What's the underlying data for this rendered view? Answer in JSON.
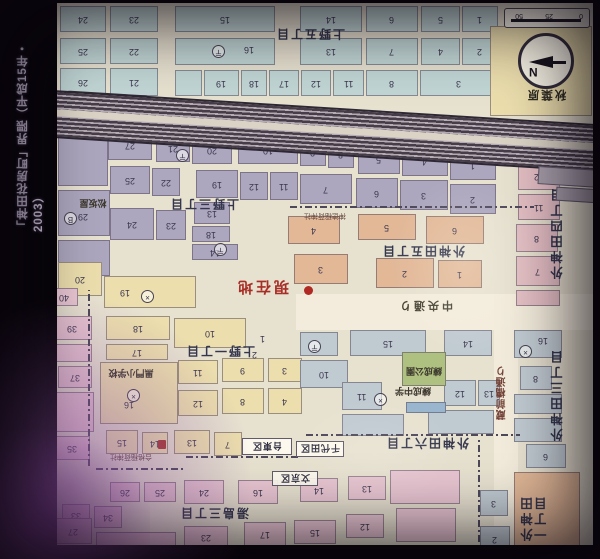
{
  "page": {
    "title": "「神田花房町」界隈（平成15年・2003）",
    "photo_note": "map printed upside-down in photo"
  },
  "compass": {
    "north": "N"
  },
  "scale_bar": {
    "t0": "0",
    "t1": "25",
    "t2": "50"
  },
  "palette": {
    "bl": "#b9d5d8",
    "pu": "#aaa3c5",
    "or": "#e8b48d",
    "sa": "#e7b9c3",
    "yl": "#ecdca1",
    "pk": "#ecc0d3",
    "bg": "#bac9d5",
    "gr": "#a9c272",
    "po": "#8fb5d7",
    "paper": "#e7e1d0",
    "accent_red": "#c0261c",
    "rail": "#463b4b"
  },
  "map": {
    "blocks": [
      [
        60,
        6,
        46,
        26,
        "bl",
        "24"
      ],
      [
        110,
        6,
        48,
        26,
        "bl",
        "23"
      ],
      [
        175,
        6,
        100,
        26,
        "bl",
        "15"
      ],
      [
        300,
        6,
        62,
        26,
        "bl",
        "14"
      ],
      [
        366,
        6,
        52,
        26,
        "bl",
        "6"
      ],
      [
        421,
        6,
        39,
        26,
        "bl",
        "5"
      ],
      [
        462,
        6,
        36,
        26,
        "bl",
        "1"
      ],
      [
        60,
        38,
        46,
        26,
        "bl",
        "25"
      ],
      [
        110,
        38,
        48,
        26,
        "bl",
        "22"
      ],
      [
        175,
        38,
        100,
        27,
        "bl",
        ""
      ],
      [
        300,
        38,
        62,
        27,
        "bl",
        "13"
      ],
      [
        366,
        38,
        52,
        27,
        "bl",
        "7"
      ],
      [
        421,
        38,
        39,
        27,
        "bl",
        "4"
      ],
      [
        462,
        38,
        36,
        27,
        "bl",
        "2"
      ],
      [
        60,
        68,
        46,
        28,
        "bl",
        "26"
      ],
      [
        110,
        68,
        48,
        28,
        "bl",
        "21"
      ],
      [
        175,
        70,
        27,
        26,
        "bl",
        ""
      ],
      [
        204,
        70,
        35,
        26,
        "bl",
        "19"
      ],
      [
        241,
        70,
        26,
        26,
        "bl",
        "18"
      ],
      [
        269,
        70,
        30,
        26,
        "bl",
        "17"
      ],
      [
        301,
        70,
        30,
        26,
        "bl",
        "12"
      ],
      [
        333,
        70,
        31,
        26,
        "bl",
        "11"
      ],
      [
        366,
        70,
        52,
        26,
        "bl",
        "8"
      ],
      [
        420,
        70,
        78,
        26,
        "bl",
        "3"
      ],
      [
        490,
        26,
        102,
        90,
        "yl",
        ""
      ],
      [
        58,
        124,
        50,
        62,
        "pu",
        ""
      ],
      [
        58,
        190,
        52,
        46,
        "pu",
        ""
      ],
      [
        58,
        240,
        52,
        36,
        "pu",
        ""
      ],
      [
        108,
        130,
        44,
        30,
        "pu",
        "27"
      ],
      [
        156,
        134,
        34,
        28,
        "pu",
        "21"
      ],
      [
        192,
        136,
        40,
        28,
        "pu",
        "20"
      ],
      [
        238,
        136,
        60,
        28,
        "pu",
        "10"
      ],
      [
        300,
        138,
        26,
        28,
        "pu",
        "9"
      ],
      [
        328,
        140,
        26,
        28,
        "pu",
        "8"
      ],
      [
        358,
        144,
        42,
        30,
        "pu",
        "5"
      ],
      [
        402,
        146,
        46,
        30,
        "pu",
        "4"
      ],
      [
        450,
        150,
        46,
        30,
        "pu",
        "1"
      ],
      [
        110,
        166,
        40,
        28,
        "pu",
        "25"
      ],
      [
        152,
        168,
        28,
        28,
        "pu",
        "22"
      ],
      [
        196,
        170,
        42,
        28,
        "pu",
        "19"
      ],
      [
        240,
        172,
        28,
        28,
        "pu",
        "12"
      ],
      [
        270,
        172,
        28,
        28,
        "pu",
        "11"
      ],
      [
        300,
        174,
        52,
        30,
        "pu",
        "7"
      ],
      [
        356,
        178,
        42,
        30,
        "pu",
        "6"
      ],
      [
        400,
        180,
        48,
        30,
        "pu",
        "3"
      ],
      [
        450,
        184,
        46,
        30,
        "pu",
        "2"
      ],
      [
        110,
        208,
        44,
        32,
        "pu",
        "24"
      ],
      [
        156,
        210,
        30,
        30,
        "pu",
        "23"
      ],
      [
        194,
        202,
        36,
        22,
        "pu",
        "13"
      ],
      [
        192,
        226,
        38,
        16,
        "pu",
        "18"
      ],
      [
        192,
        244,
        46,
        16,
        "pu",
        "14"
      ],
      [
        288,
        216,
        52,
        28,
        "or",
        "4"
      ],
      [
        358,
        214,
        58,
        26,
        "or",
        "5"
      ],
      [
        426,
        216,
        58,
        28,
        "or",
        "6"
      ],
      [
        294,
        254,
        54,
        30,
        "or",
        "3"
      ],
      [
        376,
        258,
        58,
        30,
        "or",
        "2"
      ],
      [
        438,
        260,
        44,
        28,
        "or",
        "1"
      ],
      [
        518,
        162,
        42,
        28,
        "sa",
        "12"
      ],
      [
        518,
        194,
        42,
        26,
        "sa",
        "11"
      ],
      [
        516,
        224,
        42,
        28,
        "sa",
        "8"
      ],
      [
        516,
        256,
        44,
        30,
        "sa",
        "7"
      ],
      [
        516,
        290,
        44,
        16,
        "sa",
        ""
      ],
      [
        58,
        262,
        44,
        34,
        "yl",
        "20"
      ],
      [
        104,
        276,
        92,
        32,
        "yl",
        ""
      ],
      [
        106,
        316,
        64,
        24,
        "yl",
        "18"
      ],
      [
        106,
        344,
        62,
        16,
        "yl",
        "17"
      ],
      [
        174,
        318,
        72,
        30,
        "yl",
        "10"
      ],
      [
        100,
        362,
        78,
        62,
        "yl",
        ""
      ],
      [
        178,
        360,
        40,
        24,
        "yl",
        "11"
      ],
      [
        222,
        358,
        42,
        24,
        "yl",
        "9"
      ],
      [
        268,
        358,
        34,
        24,
        "yl",
        "3"
      ],
      [
        178,
        390,
        40,
        26,
        "yl",
        "12"
      ],
      [
        222,
        388,
        42,
        26,
        "yl",
        "8"
      ],
      [
        268,
        388,
        34,
        26,
        "yl",
        "4"
      ],
      [
        106,
        430,
        32,
        24,
        "yl",
        "15"
      ],
      [
        142,
        432,
        26,
        22,
        "yl",
        "14"
      ],
      [
        174,
        430,
        36,
        24,
        "yl",
        "13"
      ],
      [
        214,
        432,
        28,
        24,
        "yl",
        "7"
      ],
      [
        350,
        330,
        76,
        26,
        "bg",
        "15"
      ],
      [
        444,
        330,
        48,
        26,
        "bg",
        "14"
      ],
      [
        300,
        332,
        38,
        24,
        "bg",
        ""
      ],
      [
        300,
        360,
        48,
        28,
        "bg",
        "10"
      ],
      [
        342,
        382,
        40,
        28,
        "bg",
        "11"
      ],
      [
        444,
        380,
        32,
        26,
        "bg",
        "12"
      ],
      [
        478,
        380,
        22,
        26,
        "bg",
        "13"
      ],
      [
        342,
        414,
        62,
        22,
        "bg",
        ""
      ],
      [
        428,
        410,
        66,
        24,
        "bg",
        ""
      ],
      [
        514,
        330,
        48,
        28,
        "bg",
        ""
      ],
      [
        520,
        366,
        32,
        24,
        "bg",
        "8"
      ],
      [
        514,
        394,
        48,
        20,
        "bg",
        ""
      ],
      [
        514,
        418,
        48,
        24,
        "bg",
        ""
      ],
      [
        526,
        444,
        40,
        24,
        "bg",
        "6"
      ],
      [
        480,
        490,
        28,
        26,
        "bg",
        "3"
      ],
      [
        480,
        526,
        30,
        26,
        "bg",
        "2"
      ],
      [
        402,
        352,
        44,
        34,
        "gr",
        ""
      ],
      [
        406,
        402,
        40,
        11,
        "po",
        ""
      ],
      [
        514,
        472,
        66,
        86,
        "or",
        ""
      ],
      [
        50,
        288,
        28,
        18,
        "pk",
        "40"
      ],
      [
        52,
        316,
        40,
        24,
        "pk",
        "39"
      ],
      [
        58,
        366,
        34,
        22,
        "pk",
        "37"
      ],
      [
        34,
        380,
        22,
        20,
        "pk",
        "38"
      ],
      [
        54,
        436,
        36,
        24,
        "pk",
        "35"
      ],
      [
        22,
        438,
        28,
        22,
        "pk",
        "36"
      ],
      [
        56,
        344,
        36,
        18,
        "pk",
        ""
      ],
      [
        56,
        392,
        38,
        40,
        "pk",
        ""
      ],
      [
        62,
        504,
        28,
        22,
        "pk",
        "33"
      ],
      [
        94,
        506,
        28,
        22,
        "pk",
        "34"
      ],
      [
        110,
        482,
        30,
        20,
        "pk",
        "26"
      ],
      [
        144,
        482,
        32,
        20,
        "pk",
        "25"
      ],
      [
        184,
        480,
        40,
        24,
        "pk",
        "24"
      ],
      [
        238,
        480,
        40,
        24,
        "pk",
        "16"
      ],
      [
        300,
        478,
        38,
        24,
        "pk",
        "14"
      ],
      [
        348,
        476,
        38,
        24,
        "pk",
        "13"
      ],
      [
        54,
        518,
        38,
        26,
        "pk",
        "27"
      ],
      [
        184,
        526,
        44,
        22,
        "pk",
        "23"
      ],
      [
        244,
        522,
        42,
        24,
        "pk",
        "17"
      ],
      [
        294,
        520,
        42,
        24,
        "pk",
        "15"
      ],
      [
        346,
        514,
        38,
        24,
        "pk",
        "12"
      ],
      [
        390,
        470,
        70,
        34,
        "pk",
        ""
      ],
      [
        396,
        508,
        60,
        34,
        "pk",
        ""
      ],
      [
        96,
        532,
        80,
        14,
        "pk",
        ""
      ]
    ],
    "labels": [
      [
        "district",
        "上野五丁目",
        266,
        27,
        88,
        15
      ],
      [
        "district",
        "上野三丁目",
        160,
        197,
        88,
        16
      ],
      [
        "district",
        "上野一丁目",
        180,
        344,
        80,
        15
      ],
      [
        "district",
        "湯島三丁目",
        184,
        506,
        60,
        15
      ],
      [
        "district",
        "外神田五丁目",
        362,
        243,
        122,
        17
      ],
      [
        "district",
        "外神田六丁目",
        390,
        437,
        74,
        14
      ],
      [
        "districtv",
        "外神田四丁目",
        552,
        180,
        24,
        106
      ],
      [
        "districtv",
        "外神田三丁目",
        552,
        340,
        24,
        110
      ],
      [
        "districtv",
        "外神田一丁目",
        522,
        488,
        46,
        60
      ],
      [
        "street",
        "中央通り",
        390,
        298,
        70,
        17
      ],
      [
        "streetv",
        "蔵前橋通り",
        495,
        352,
        20,
        82
      ],
      [
        "station",
        "JR御徒町駅",
        60,
        93,
        94,
        21
      ],
      [
        "poi2",
        "秋葉原",
        516,
        86,
        60,
        18
      ],
      [
        "poi",
        "松坂屋",
        72,
        197,
        42,
        14
      ],
      [
        "poi",
        "黒門小学校",
        102,
        367,
        58,
        13
      ],
      [
        "poi",
        "練成中学",
        390,
        386,
        46,
        12
      ],
      [
        "poi",
        "練成公園",
        404,
        366,
        40,
        12
      ],
      [
        "tiny",
        "神徳稲荷神社",
        296,
        211,
        58,
        11
      ],
      [
        "tiny",
        "合格稲荷神社",
        92,
        451,
        78,
        12
      ],
      [
        "ward",
        "台東区",
        242,
        438,
        50,
        17
      ],
      [
        "ward",
        "千代田区",
        296,
        441,
        48,
        16
      ],
      [
        "ward",
        "文京区",
        272,
        471,
        46,
        15
      ],
      [
        "red",
        "現在地",
        229,
        277,
        66,
        21
      ]
    ],
    "icons": [
      [
        212,
        45,
        "post"
      ],
      [
        176,
        149,
        "post"
      ],
      [
        214,
        243,
        "post"
      ],
      [
        308,
        340,
        "post"
      ],
      [
        141,
        290,
        "police"
      ],
      [
        127,
        389,
        "police"
      ],
      [
        374,
        393,
        "police"
      ],
      [
        519,
        345,
        "police"
      ],
      [
        64,
        212,
        "bank"
      ],
      [
        158,
        440,
        "shrine"
      ],
      [
        304,
        286,
        "reddot"
      ]
    ],
    "floating_numbers": [
      [
        244,
        45,
        "16"
      ],
      [
        120,
        288,
        "19"
      ],
      [
        124,
        400,
        "16"
      ],
      [
        78,
        212,
        "29"
      ],
      [
        260,
        334,
        "1"
      ],
      [
        252,
        350,
        "2"
      ],
      [
        556,
        416,
        "7"
      ],
      [
        538,
        336,
        "16"
      ]
    ],
    "boundaries": [
      [
        290,
        206,
        244,
        "h"
      ],
      [
        96,
        468,
        88,
        "h"
      ],
      [
        186,
        456,
        114,
        "h"
      ],
      [
        306,
        434,
        214,
        "h"
      ],
      [
        88,
        290,
        176,
        "v"
      ],
      [
        478,
        438,
        104,
        "v"
      ]
    ]
  }
}
